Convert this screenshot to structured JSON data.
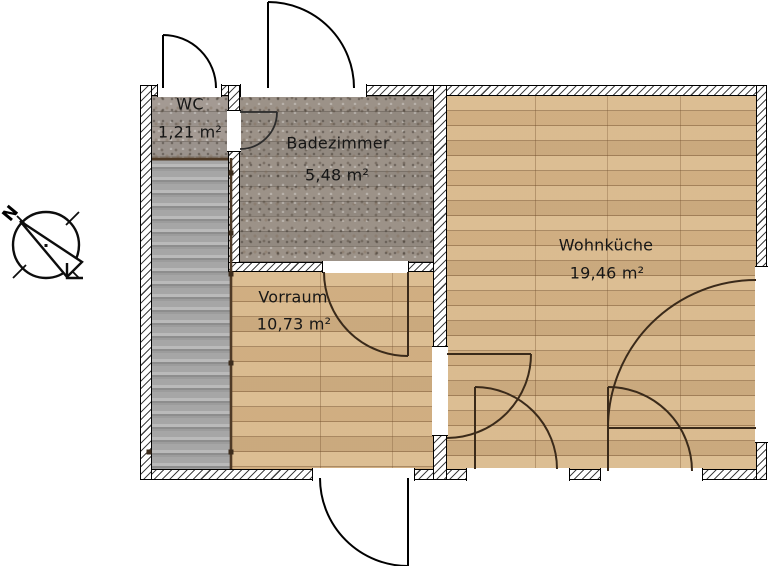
{
  "compass": {
    "north_label": "N"
  },
  "rooms": [
    {
      "name": "WC",
      "area": "1,21 m²"
    },
    {
      "name": "Badezimmer",
      "area": "5,48 m²"
    },
    {
      "name": "Vorraum",
      "area": "10,73 m²"
    },
    {
      "name": "Wohnküche",
      "area": "19,46 m²"
    }
  ],
  "colors": {
    "wood_floor": "#d8b88b",
    "stone_floor": "#9e958c",
    "wc_floor": "#a8a09a",
    "stairs": "#a5a5a5",
    "wall_fill": "#ffffff",
    "hatch_line": "#444444",
    "outline": "#000000",
    "interior_door": "#3a2a1a",
    "exterior_door": "#000000"
  }
}
